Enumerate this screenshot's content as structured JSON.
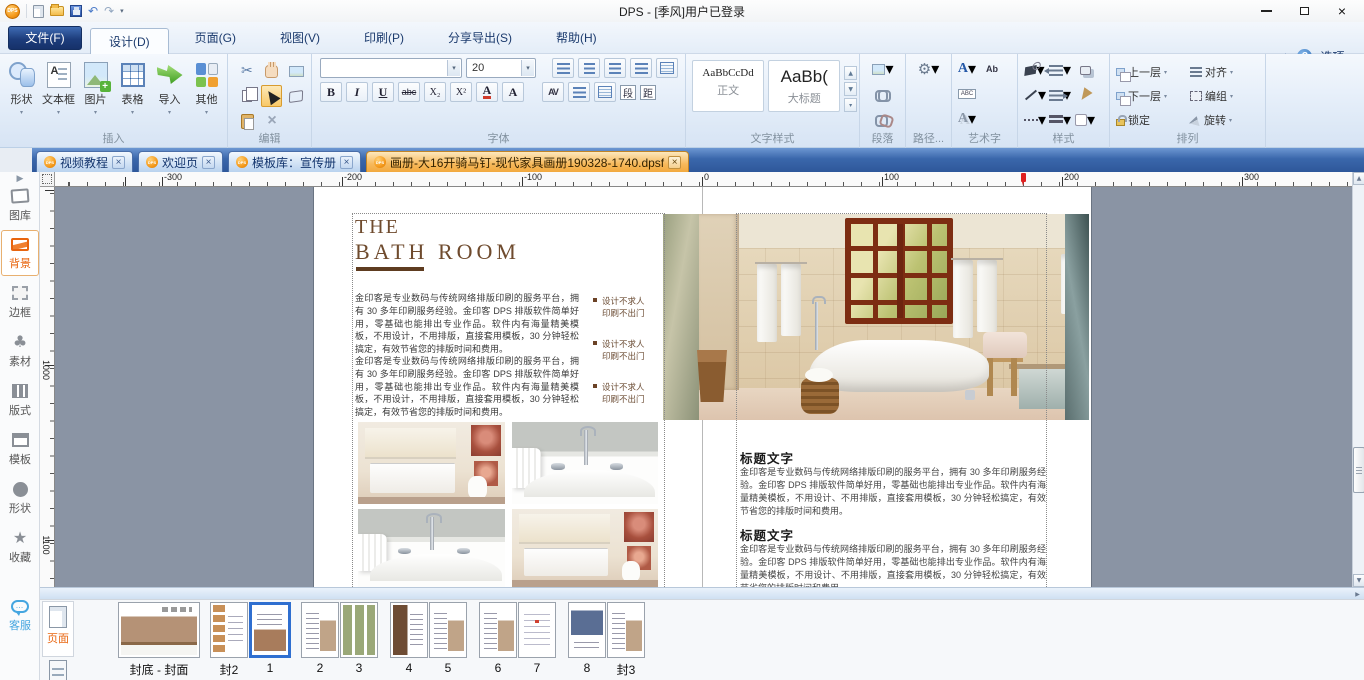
{
  "titlebar": {
    "title": "DPS - [季风]用户已登录",
    "logo_text": "DPS"
  },
  "menubar": {
    "file": "文件(F)",
    "tabs": [
      "设计(D)",
      "页面(G)",
      "视图(V)",
      "印刷(P)",
      "分享导出(S)",
      "帮助(H)"
    ],
    "options": "选项",
    "help": "?"
  },
  "ribbon": {
    "insert": {
      "label": "插入",
      "buttons": [
        "形状",
        "文本框",
        "图片",
        "表格",
        "导入",
        "其他"
      ]
    },
    "edit": {
      "label": "编辑"
    },
    "font": {
      "label": "字体",
      "size": "20",
      "bold": "B",
      "italic": "I",
      "underline": "U",
      "strike": "abc",
      "sub": "X₂",
      "sup": "X²",
      "color": "A",
      "highlight": "A",
      "spacing": "AV",
      "para_btn": "段",
      "dist_btn": "距"
    },
    "text_style": {
      "label": "文字样式",
      "styles": [
        {
          "preview": "AaBbCcDd",
          "name": "正文"
        },
        {
          "preview": "AaBb(",
          "name": "大标题"
        }
      ]
    },
    "paragraph": {
      "label": "段落"
    },
    "path": {
      "label": "路径..."
    },
    "wordart": {
      "label": "艺术字",
      "a1": "A",
      "ab": "Ab",
      "abc": "ABC",
      "a2": "A"
    },
    "style": {
      "label": "样式"
    },
    "arrange": {
      "label": "排列",
      "buttons": [
        "上一层",
        "下一层",
        "锁定",
        "对齐",
        "编组",
        "旋转"
      ]
    }
  },
  "doc_tabs": [
    {
      "label": "视频教程"
    },
    {
      "label": "欢迎页"
    },
    {
      "label": "模板库：宣传册"
    },
    {
      "label": "画册-大16开骑马钉-现代家具画册190328-1740.dpsf"
    }
  ],
  "sidebar": {
    "items": [
      "图库",
      "背景",
      "边框",
      "素材",
      "版式",
      "模板",
      "形状",
      "收藏"
    ],
    "support": "客服"
  },
  "rulers": {
    "h": [
      "-300",
      "-200",
      "-100",
      "0",
      "100",
      "200",
      "300"
    ],
    "v": [
      "1000",
      "1100"
    ]
  },
  "document": {
    "title_line1": "THE",
    "title_line2": "BATH ROOM",
    "paragraph": "金印客是专业数码与传统网络排版印刷的服务平台，拥有 30 多年印刷服务经验。金印客 DPS 排版软件简单好用，零基础也能排出专业作品。软件内有海量精美模板，不用设计，不用排版，直接套用模板，30 分钟轻松搞定，有效节省您的排版时间和费用。",
    "bullet_line1": "设计不求人",
    "bullet_line2": "印刷不出门",
    "heading": "标题文字",
    "section_body": "金印客是专业数码与传统网络排版印刷的服务平台，拥有 30 多年印刷服务经验。金印客 DPS 排版软件简单好用，零基础也能排出专业作品。软件内有海量精美模板，不用设计、不用排版，直接套用模板，30 分钟轻松搞定，有效节省您的排版时间和费用。"
  },
  "pages_panel": {
    "tab": "页面",
    "thumbs": [
      "封底 - 封面",
      "封2",
      "1",
      "2",
      "3",
      "4",
      "5",
      "6",
      "7",
      "8",
      "封3"
    ]
  },
  "glyphs": {
    "close": "×",
    "dd": "▾",
    "up": "▲",
    "down": "▼",
    "play": "▶",
    "undo": "↶",
    "redo": "↷",
    "scissors": "✂",
    "x": "×",
    "gear": "⚙",
    "flower": "♣",
    "star": "★",
    "dots": "…",
    "left": "◀",
    "right": "▶"
  }
}
